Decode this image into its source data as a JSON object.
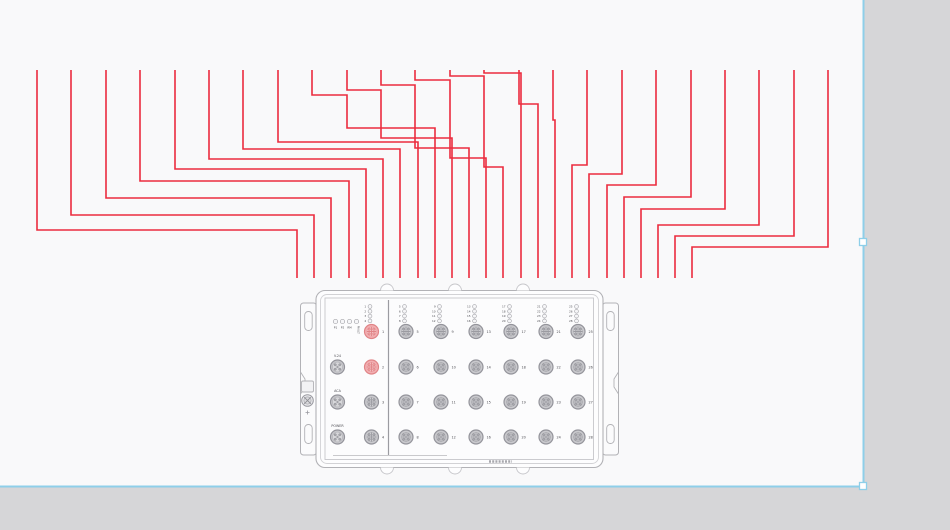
{
  "canvas": {
    "sheet_color": "#f9f9fa",
    "frame_color": "#d6d6d8",
    "selection_color": "#8ecfe9",
    "sheet": {
      "w": 863,
      "h": 486
    },
    "handles": [
      {
        "x": 863,
        "y": 242
      },
      {
        "x": 863,
        "y": 486
      }
    ]
  },
  "wires": {
    "color": "#ec2c3e",
    "width": 1.6,
    "paths": [
      [
        [
          37,
          70
        ],
        [
          37,
          230
        ],
        [
          297,
          230
        ],
        [
          297,
          278
        ]
      ],
      [
        [
          71,
          70
        ],
        [
          71,
          215
        ],
        [
          314,
          215
        ],
        [
          314,
          278
        ]
      ],
      [
        [
          106,
          70
        ],
        [
          106,
          198
        ],
        [
          331,
          198
        ],
        [
          331,
          278
        ]
      ],
      [
        [
          140,
          70
        ],
        [
          140,
          181
        ],
        [
          349,
          181
        ],
        [
          349,
          278
        ]
      ],
      [
        [
          175,
          70
        ],
        [
          175,
          169
        ],
        [
          366,
          169
        ],
        [
          366,
          278
        ]
      ],
      [
        [
          209,
          70
        ],
        [
          209,
          159
        ],
        [
          383,
          159
        ],
        [
          383,
          278
        ]
      ],
      [
        [
          243,
          70
        ],
        [
          243,
          149
        ],
        [
          400,
          149
        ],
        [
          400,
          278
        ]
      ],
      [
        [
          278,
          70
        ],
        [
          278,
          142
        ],
        [
          418,
          142
        ],
        [
          418,
          278
        ]
      ],
      [
        [
          312,
          70
        ],
        [
          312,
          95
        ],
        [
          347,
          95
        ],
        [
          347,
          128
        ],
        [
          435,
          128
        ],
        [
          435,
          278
        ]
      ],
      [
        [
          347,
          70
        ],
        [
          347,
          90
        ],
        [
          381,
          90
        ],
        [
          381,
          138
        ],
        [
          452,
          138
        ],
        [
          452,
          278
        ]
      ],
      [
        [
          381,
          70
        ],
        [
          381,
          85
        ],
        [
          415,
          85
        ],
        [
          415,
          148
        ],
        [
          469,
          148
        ],
        [
          469,
          278
        ]
      ],
      [
        [
          415,
          70
        ],
        [
          415,
          80
        ],
        [
          450,
          80
        ],
        [
          450,
          158
        ],
        [
          486,
          158
        ],
        [
          486,
          278
        ]
      ],
      [
        [
          450,
          70
        ],
        [
          450,
          76
        ],
        [
          484,
          76
        ],
        [
          484,
          167
        ],
        [
          503,
          167
        ],
        [
          503,
          278
        ]
      ],
      [
        [
          484,
          70
        ],
        [
          484,
          73
        ],
        [
          521,
          73
        ],
        [
          521,
          278
        ]
      ],
      [
        [
          519,
          70
        ],
        [
          519,
          104
        ],
        [
          538,
          104
        ],
        [
          538,
          278
        ]
      ],
      [
        [
          553,
          70
        ],
        [
          553,
          120
        ],
        [
          555,
          120
        ],
        [
          555,
          278
        ]
      ],
      [
        [
          587,
          70
        ],
        [
          587,
          165
        ],
        [
          572,
          165
        ],
        [
          572,
          278
        ]
      ],
      [
        [
          622,
          70
        ],
        [
          622,
          174
        ],
        [
          589,
          174
        ],
        [
          589,
          278
        ]
      ],
      [
        [
          656,
          70
        ],
        [
          656,
          185
        ],
        [
          607,
          185
        ],
        [
          607,
          278
        ]
      ],
      [
        [
          691,
          70
        ],
        [
          691,
          197
        ],
        [
          624,
          197
        ],
        [
          624,
          278
        ]
      ],
      [
        [
          725,
          70
        ],
        [
          725,
          209
        ],
        [
          641,
          209
        ],
        [
          641,
          278
        ]
      ],
      [
        [
          759,
          70
        ],
        [
          759,
          225
        ],
        [
          658,
          225
        ],
        [
          658,
          278
        ]
      ],
      [
        [
          794,
          70
        ],
        [
          794,
          236
        ],
        [
          675,
          236
        ],
        [
          675,
          278
        ]
      ],
      [
        [
          828,
          70
        ],
        [
          828,
          247
        ],
        [
          692,
          247
        ],
        [
          692,
          278
        ]
      ]
    ]
  },
  "device": {
    "colors": {
      "outline": "#b2b2b6",
      "outline_light": "#d2d2d5",
      "face_line": "#c6c6ca",
      "divider": "#9b9ba1",
      "body_fill": "#fdfdfe",
      "face_fill": "#fcfcfd",
      "port_ring": "#94949b",
      "port_fill": "#c9c9cd",
      "port_inner": "#d7d7da",
      "pin": "#a9a9af",
      "hl_ring": "#e08487",
      "hl_fill": "#f2aeb1",
      "hl_inner": "#f7c5c7",
      "hl_pin": "#ee9b9e",
      "text": "#4c4c52",
      "led_stroke": "#a8a8ad",
      "led_fill": "#f6f6f8"
    },
    "housing": {
      "x": 316,
      "y": 290.5,
      "w": 287,
      "h": 177
    },
    "divider_x": 388.5,
    "edge_tab_xs": [
      387,
      455,
      523
    ],
    "status_leds": {
      "y": 321.5,
      "xs": [
        335.5,
        342.5,
        349.5,
        356.5
      ],
      "labels": [
        "P1",
        "P2",
        "RM",
        "FAULT"
      ]
    },
    "left_connectors": [
      {
        "label": "V.24",
        "y": 367
      },
      {
        "label": "ACA",
        "y": 402
      },
      {
        "label": "POWER",
        "y": 437
      }
    ],
    "left_connector_x": 337.5,
    "row_ys": [
      331.5,
      367,
      402,
      437
    ],
    "led_stack_ys": [
      306.5,
      311.3,
      316.1,
      320.9
    ],
    "columns": [
      {
        "x": 371.5,
        "ports": [
          1,
          2,
          3,
          4
        ],
        "highlighted": [
          1,
          2
        ]
      },
      {
        "x": 406,
        "ports": [
          5,
          6,
          7,
          8
        ]
      },
      {
        "x": 441,
        "ports": [
          9,
          10,
          11,
          12
        ]
      },
      {
        "x": 476,
        "ports": [
          13,
          14,
          15,
          16
        ]
      },
      {
        "x": 511,
        "ports": [
          17,
          18,
          19,
          20
        ]
      },
      {
        "x": 546,
        "ports": [
          21,
          22,
          23,
          24
        ]
      },
      {
        "x": 578,
        "ports": [
          25,
          26,
          27,
          28
        ]
      }
    ],
    "bottom_label": {
      "x1": 489,
      "x2": 512,
      "y": 461.5
    }
  }
}
